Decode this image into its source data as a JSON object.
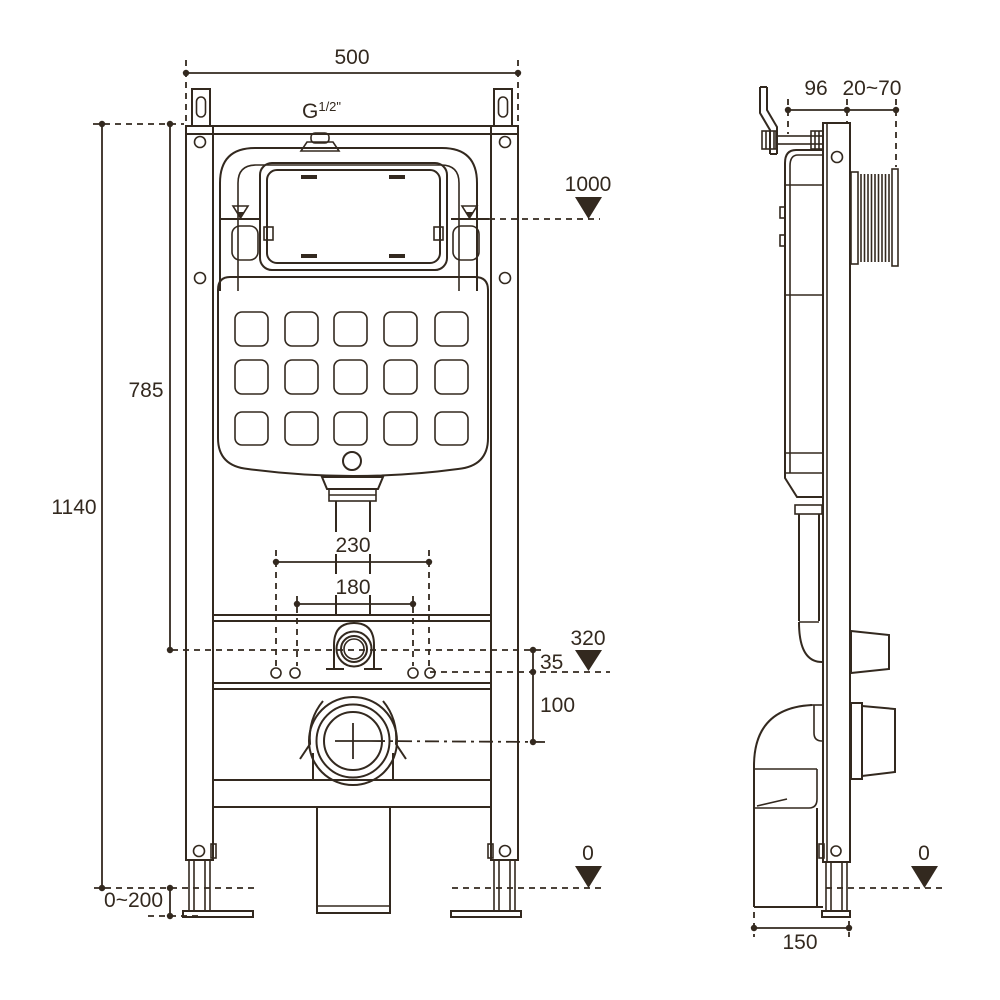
{
  "title": "Concealed cistern wall-frame installation drawing",
  "colors": {
    "ink": "#33291f",
    "background": "#ffffff"
  },
  "front_view": {
    "dims": {
      "frame_width": "500",
      "thread_base": "G",
      "thread_sup": "1/2\"",
      "water_level_height": "1000",
      "tank_top_height": "785",
      "frame_height": "1140",
      "bolt_span_outer": "230",
      "bolt_span_inner": "180",
      "reference_level": "320",
      "offset_inlet": "35",
      "offset_drain": "100",
      "foot_adjust_range": "0~200",
      "floor_level": "0"
    }
  },
  "side_view": {
    "dims": {
      "bracket_depth": "96",
      "wall_distance_range": "20~70",
      "floor_level": "0",
      "drain_offset": "150"
    }
  }
}
